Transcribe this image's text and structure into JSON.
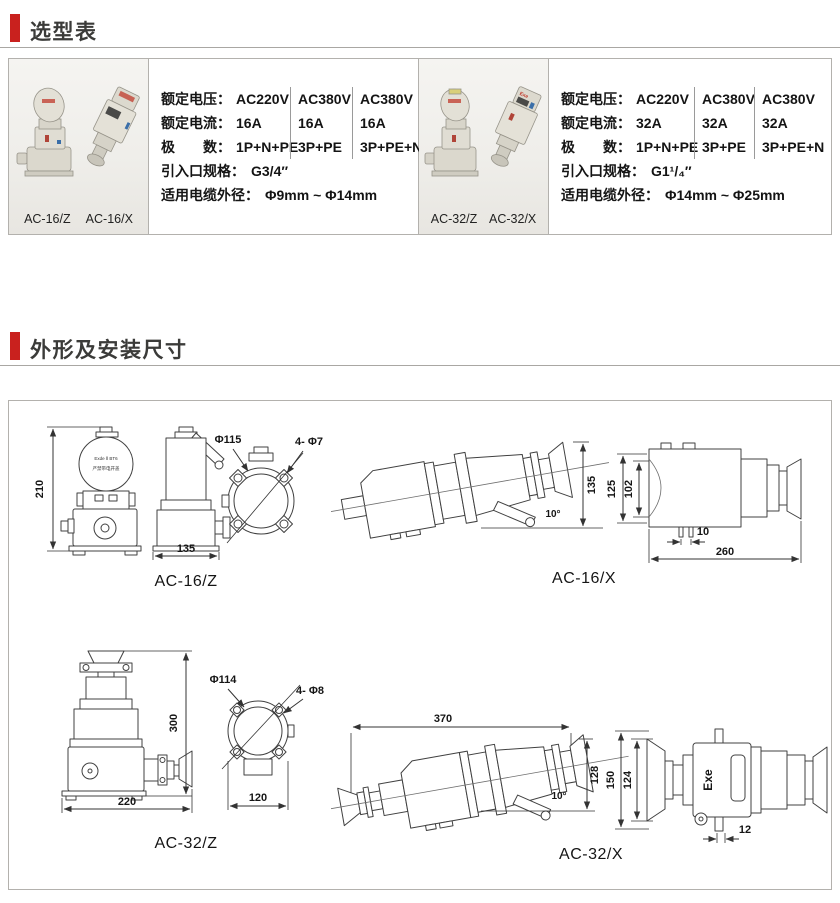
{
  "page": {
    "accent_color": "#c9211e",
    "sections": {
      "selection": "选型表",
      "dimensions": "外形及安装尺寸"
    }
  },
  "selection_tables": [
    {
      "products": [
        "AC-16/Z",
        "AC-16/X"
      ],
      "voltage_label": "额定电压：",
      "current_label": "额定电流：",
      "poles_label": "极　　数：",
      "inlet_label": "引入口规格：",
      "cable_label": "适用电缆外径：",
      "voltage": [
        "AC220V",
        "AC380V",
        "AC380V"
      ],
      "current": [
        "16A",
        "16A",
        "16A"
      ],
      "poles": [
        "1P+N+PE",
        "3P+PE",
        "3P+PE+N"
      ],
      "inlet": "G3/4″",
      "cable": "Φ9mm ~ Φ14mm"
    },
    {
      "products": [
        "AC-32/Z",
        "AC-32/X"
      ],
      "photo_text": "Exe",
      "voltage_label": "额定电压：",
      "current_label": "额定电流：",
      "poles_label": "极　　数：",
      "inlet_label": "引入口规格：",
      "cable_label": "适用电缆外径：",
      "voltage": [
        "AC220V",
        "AC380V",
        "AC380V"
      ],
      "current": [
        "32A",
        "32A",
        "32A"
      ],
      "poles": [
        "1P+N+PE",
        "3P+PE",
        "3P+PE+N"
      ],
      "inlet": "G1¹/₄″",
      "cable": "Φ14mm ~ Φ25mm"
    }
  ],
  "drawings": {
    "ac16z": {
      "label": "AC-16/Z",
      "cover_line1": "Exde Ⅱ BT6",
      "cover_line2": "严禁带电开盖",
      "dims": {
        "height": "210",
        "base_width": "135",
        "mount_circle": "Φ115",
        "mount_holes": "4- Φ7"
      }
    },
    "ac16x": {
      "label": "AC-16/X",
      "dims": {
        "tilt": "10°",
        "height": "135",
        "body_od": "125",
        "body_id": "102",
        "foot_offset": "10",
        "length": "260"
      }
    },
    "ac32z": {
      "label": "AC-32/Z",
      "dims": {
        "height": "300",
        "base_width": "220",
        "mount_circle": "Φ114",
        "mount_holes": "4- Φ8",
        "flange_width": "120"
      }
    },
    "ac32x": {
      "label": "AC-32/X",
      "body_text": "Exe",
      "dims": {
        "length": "370",
        "tilt": "10°",
        "height": "128",
        "body_od": "150",
        "body_id": "124",
        "foot_offset": "12"
      }
    }
  }
}
